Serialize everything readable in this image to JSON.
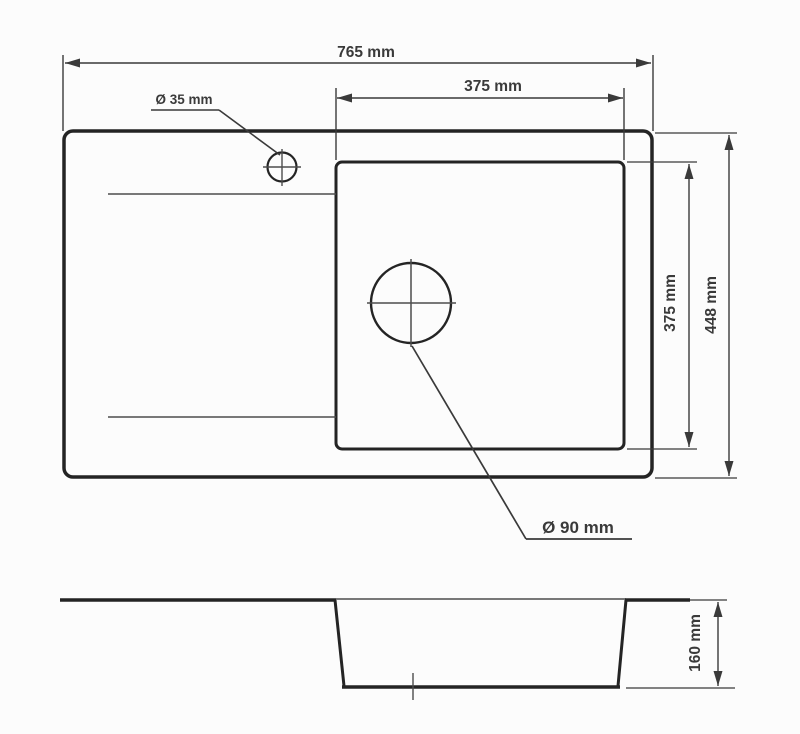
{
  "drawing": {
    "top_view": {
      "overall_width_label": "765 mm",
      "bowl_width_label": "375 mm",
      "bowl_height_label": "375 mm",
      "overall_depth_label": "448 mm",
      "faucet_hole_label": "Ø 35 mm",
      "drain_hole_label": "Ø 90 mm"
    },
    "section_view": {
      "bowl_depth_label": "160 mm"
    },
    "colors": {
      "line_thick": "#242424",
      "line_thin": "#4d4d4d",
      "dimension": "#3a3a3a",
      "background": "#fcfcfc"
    }
  }
}
